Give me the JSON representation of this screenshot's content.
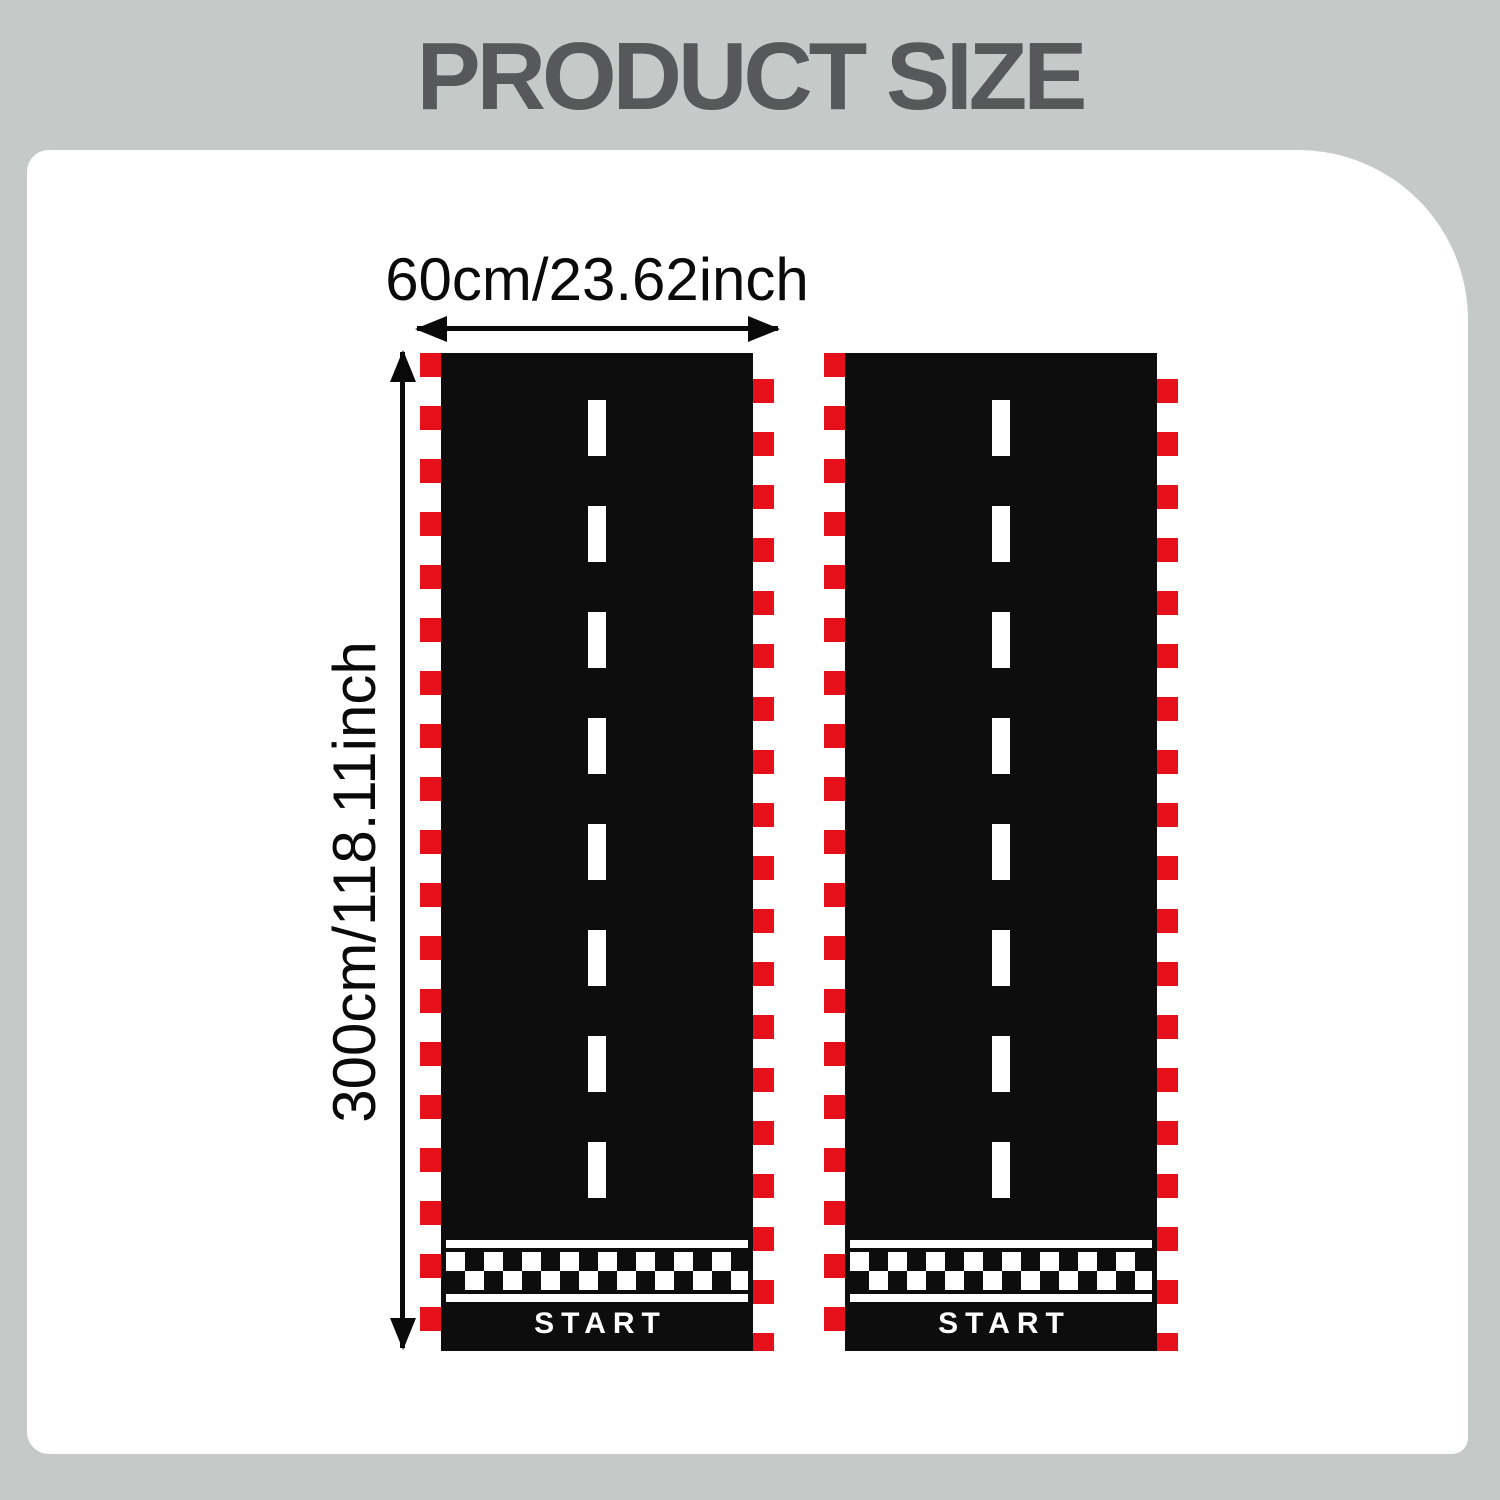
{
  "title": "PRODUCT SIZE",
  "dimension_labels": {
    "width": "60cm/23.62inch",
    "height": "300cm/118.11inch"
  },
  "tracks": [
    {
      "name": "left racing track mat",
      "start_label": "START"
    },
    {
      "name": "right racing track mat",
      "start_label": "START"
    }
  ],
  "colors": {
    "background": "#c5c9c8",
    "panel": "#ffffff",
    "title-text": "#57585a",
    "track-black": "#0d0d0d",
    "border-red": "#e6101b",
    "marking-white": "#ffffff",
    "dimension-ink": "#0a0a0a"
  }
}
